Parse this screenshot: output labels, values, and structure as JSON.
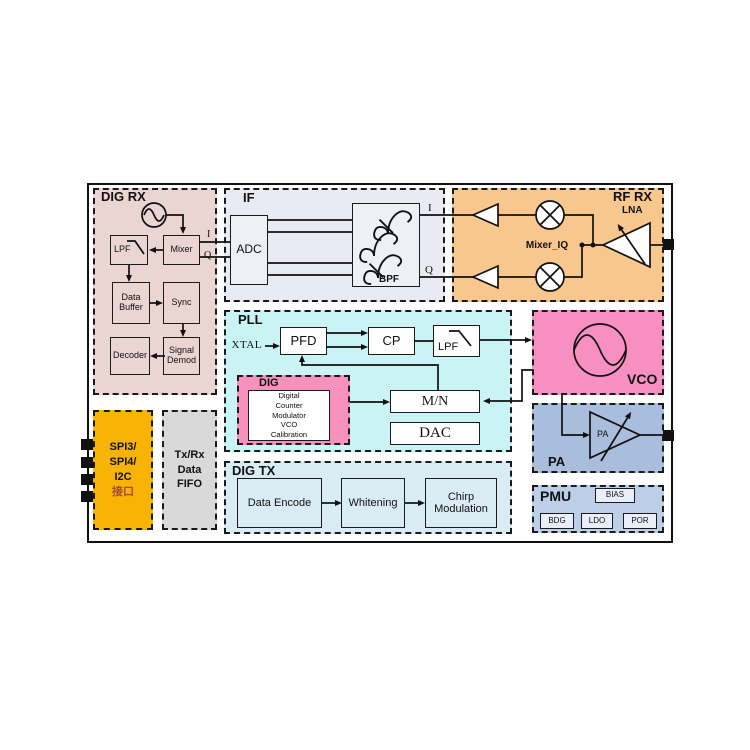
{
  "colors": {
    "dig_rx_bg": "#ead5d3",
    "if_bg": "#e9eaf3",
    "if_box_bg": "#eef0f8",
    "rf_rx_bg": "#f7c78e",
    "pll_bg": "#c9f3f5",
    "dig_bg": "#f591bc",
    "vco_bg": "#f88fc2",
    "pa_bg": "#a9bedd",
    "pmu_bg": "#bccee8",
    "pmu_box_bg": "#e9eef8",
    "spi_bg": "#f8b404",
    "fifo_bg": "#d9d9d9",
    "dig_tx_bg": "#d9ecf4",
    "spi_cn_color": "#a5483f",
    "line_color": "#111111"
  },
  "blocks": {
    "dig_rx": {
      "title": "DIG RX",
      "lpf": "LPF",
      "mixer": "Mixer",
      "data_buffer": "Data Buffer",
      "sync": "Sync",
      "decoder": "Decoder",
      "signal_demod": "Signal Demod",
      "i": "I",
      "q": "Q"
    },
    "if_blk": {
      "title": "IF",
      "adc": "ADC",
      "bpf": "BPF",
      "i": "I",
      "q": "Q"
    },
    "rf_rx": {
      "title": "RF RX",
      "mixer_iq": "Mixer_IQ",
      "lna": "LNA"
    },
    "pll": {
      "title": "PLL",
      "xtal": "XTAL",
      "pfd": "PFD",
      "cp": "CP",
      "lpf": "LPF",
      "mn": "M/N",
      "dac": "DAC",
      "dig": {
        "title": "DIG",
        "lines": [
          "Digital",
          "Counter",
          "Modulator",
          "VCO",
          "Calibration"
        ]
      }
    },
    "vco": {
      "title": "VCO"
    },
    "pa": {
      "title": "PA",
      "amp": "PA"
    },
    "spi": {
      "l1": "SPI3/",
      "l2": "SPI4/",
      "l3": "I2C",
      "l4": "接口"
    },
    "fifo": {
      "l1": "Tx/Rx",
      "l2": "Data",
      "l3": "FIFO"
    },
    "dig_tx": {
      "title": "DIG TX",
      "data_encode": "Data Encode",
      "whitening": "Whitening",
      "chirp": "Chirp Modulation"
    },
    "pmu": {
      "title": "PMU",
      "bias": "BIAS",
      "bdg": "BDG",
      "ldo": "LDO",
      "por": "POR"
    }
  }
}
